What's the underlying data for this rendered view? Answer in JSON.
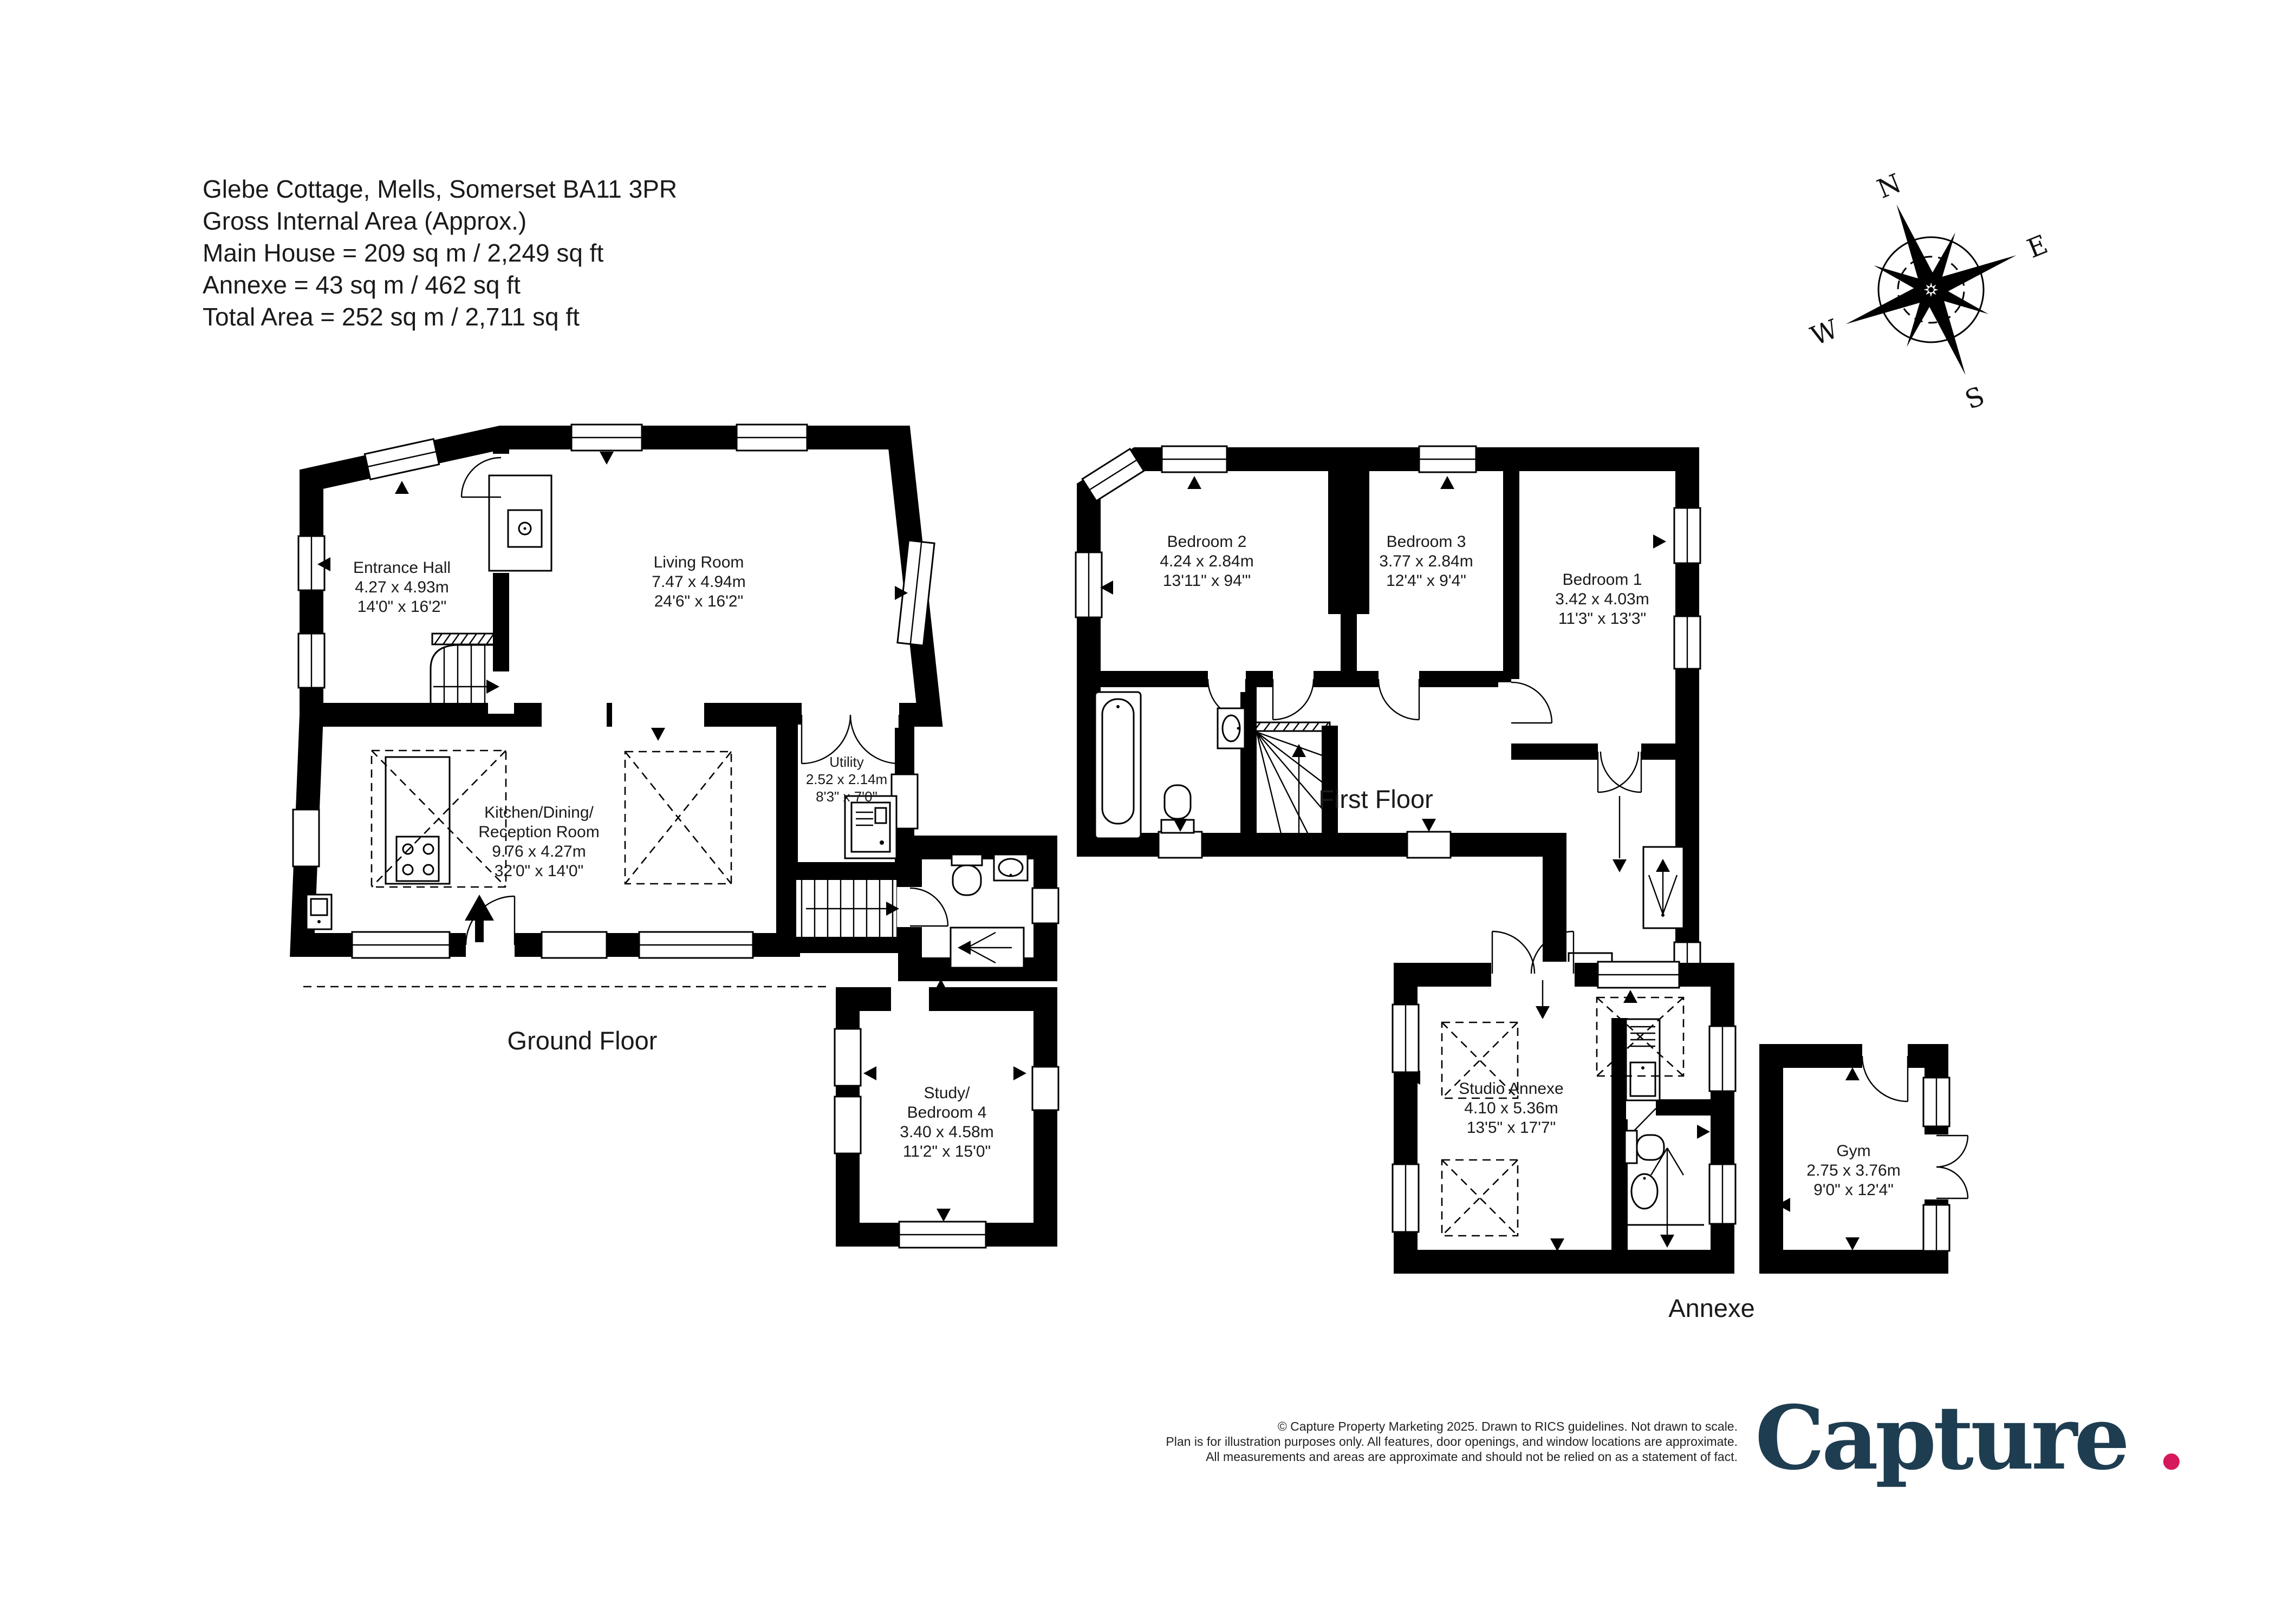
{
  "header": {
    "address": "Glebe Cottage, Mells, Somerset  BA11 3PR",
    "gross_internal": "Gross Internal Area (Approx.)",
    "main_house": "Main House = 209 sq m / 2,249 sq ft",
    "annexe_area": "Annexe = 43 sq m / 462 sq ft",
    "total_area": "Total Area = 252 sq m / 2,711 sq ft"
  },
  "compass": {
    "north": "N",
    "east": "E",
    "south": "S",
    "west": "W"
  },
  "floor_labels": {
    "ground": "Ground Floor",
    "first": "First Floor",
    "annexe": "Annexe"
  },
  "rooms": {
    "entrance_hall": {
      "name": "Entrance Hall",
      "metric": "4.27 x 4.93m",
      "imperial": "14'0\" x 16'2\""
    },
    "living_room": {
      "name": "Living Room",
      "metric": "7.47 x 4.94m",
      "imperial": "24'6\" x 16'2\""
    },
    "kitchen": {
      "name": "Kitchen/Dining/",
      "name2": "Reception Room",
      "metric": "9.76 x 4.27m",
      "imperial": "32'0\" x 14'0\""
    },
    "utility": {
      "name": "Utility",
      "metric": "2.52 x 2.14m",
      "imperial": "8'3\" x 7'0\""
    },
    "study": {
      "name": "Study/",
      "name2": "Bedroom 4",
      "metric": "3.40 x 4.58m",
      "imperial": "11'2\" x 15'0\""
    },
    "bedroom2": {
      "name": "Bedroom 2",
      "metric": "4.24 x 2.84m",
      "imperial": "13'11\" x 94'\""
    },
    "bedroom3": {
      "name": "Bedroom 3",
      "metric": "3.77 x 2.84m",
      "imperial": "12'4\" x 9'4\""
    },
    "bedroom1": {
      "name": "Bedroom 1",
      "metric": "3.42 x 4.03m",
      "imperial": "11'3\" x 13'3\""
    },
    "studio": {
      "name": "Studio Annexe",
      "metric": "4.10 x 5.36m",
      "imperial": "13'5\" x 17'7\""
    },
    "gym": {
      "name": "Gym",
      "metric": "2.75 x 3.76m",
      "imperial": "9'0\" x 12'4\""
    }
  },
  "footer": {
    "line1": "© Capture Property Marketing 2025. Drawn to RICS guidelines.  Not drawn to scale.",
    "line2": "Plan is for illustration purposes only. All features, door openings, and window locations are approximate.",
    "line3": "All measurements and areas are approximate and should not be relied on as a statement of fact."
  },
  "logo": {
    "text": "Capture",
    "dot": ".",
    "color": "#1e3d51",
    "dot_color": "#d6195c"
  }
}
